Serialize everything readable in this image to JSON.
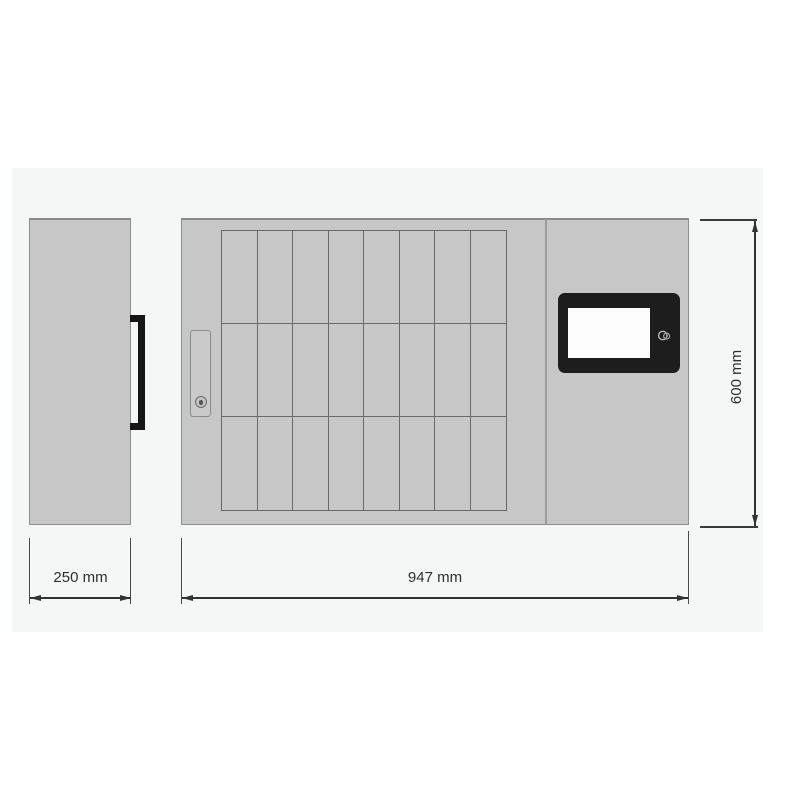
{
  "dimensions": {
    "side_width": {
      "label": "250 mm"
    },
    "front_width": {
      "label": "947 mm"
    },
    "front_height": {
      "label": "600 mm"
    }
  },
  "front_view": {
    "key_slot_grid": {
      "rows": 3,
      "columns": 8
    },
    "display": {
      "type": "touchscreen",
      "screen_content": ""
    }
  },
  "icons": [
    "keyhole-icon",
    "card-reader-icon",
    "door-handle"
  ],
  "colors": {
    "page_background": "#ffffff",
    "backdrop": "#f5f6f6",
    "cabinet_fill": "#c7c7c7",
    "cabinet_border": "#8f8f8f",
    "grid_line": "#6a6a6a",
    "handle_black": "#161616",
    "display_bezel": "#1d1d1d",
    "display_screen": "#fdfdfd",
    "dimension_line": "#333333",
    "label_text": "#2e2e2e"
  }
}
